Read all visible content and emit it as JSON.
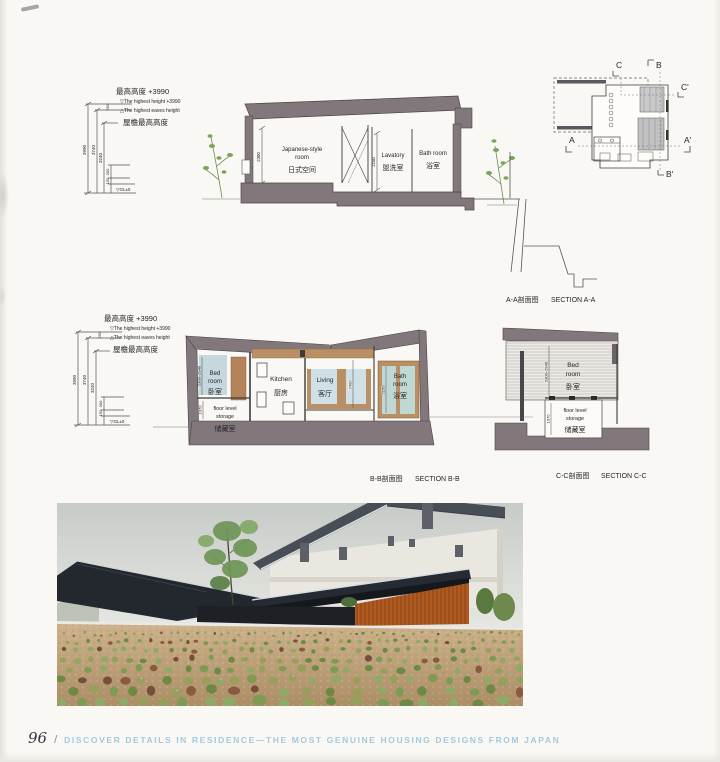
{
  "page": {
    "number": "96",
    "separator": "/",
    "footer_title": "DISCOVER DETAILS IN RESIDENCE—THE MOST GENUINE HOUSING DESIGNS FROM JAPAN"
  },
  "colors": {
    "roof_gray": "#82787c",
    "dark_line": "#4a4347",
    "wood_tan": "#b98f63",
    "wood_panel": "#b5835a",
    "glass_blue": "#cfe0e6",
    "bed_blue": "#c6d7dd",
    "photo_roof": "#23272e",
    "photo_wood": "#b05a22",
    "gravel": "#c6ab85",
    "plant_greens": [
      "#7d9c52",
      "#8fa967",
      "#6c8a43",
      "#96a05a",
      "#74503a",
      "#8a5a3f"
    ],
    "flower_pink": "#d9a0bd",
    "footer_blue": "#a3c9de"
  },
  "annotation_top": {
    "line1": "最高高度 +3990",
    "line2": "▽The highest height +3990",
    "line3": "△The highest eaves height",
    "line4": "屋檐最高高度",
    "dim_total": "3990",
    "dim_mid": "3740",
    "dim_inner": "3240",
    "dim_s_top": "250",
    "dim_s1": "300",
    "dim_s2": "150",
    "gl": "▽GL±0"
  },
  "annotation_mid": {
    "line1": "最高高度 +3990",
    "line2": "▽The highest height +3990",
    "line3": "△The highest eaves height",
    "line4": "屋檐最高高度",
    "dim_total": "3990",
    "dim_mid": "3740",
    "dim_inner": "3240",
    "dim_s_top": "250",
    "dim_s1": "300",
    "dim_s2": "150",
    "gl": "▽GL±0"
  },
  "section_a": {
    "caption_cn": "A-A剖面图",
    "caption_en": "SECTION A-A",
    "room1_en1": "Japanese-style",
    "room1_en2": "room",
    "room1_cn": "日式空间",
    "room1_dim": "2300",
    "room2_en": "Lavatory",
    "room2_cn": "盥洗室",
    "room2_dim": "2150",
    "room3_en": "Bath room",
    "room3_cn": "浴室"
  },
  "section_b": {
    "caption_cn": "B-B剖面图",
    "caption_en": "SECTION B-B",
    "bed_en1": "Bed",
    "bed_en2": "room",
    "bed_cn": "卧室",
    "bed_dim": "2300~2940",
    "storage_en1": "floor level",
    "storage_en2": "storage",
    "storage_cn": "储藏室",
    "storage_dim": "1070",
    "kitchen_en": "Kitchen",
    "kitchen_cn": "厨房",
    "living_en": "Living",
    "living_cn": "客厅",
    "living_dim": "2400",
    "bath_en1": "Bath",
    "bath_en2": "room",
    "bath_cn": "浴室",
    "bath_dim": "2150"
  },
  "section_c": {
    "caption_cn": "C-C剖面图",
    "caption_en": "SECTION C-C",
    "bed_en1": "Bed",
    "bed_en2": "room",
    "bed_cn": "卧室",
    "bed_dim": "2300~2940",
    "storage_en1": "floor level",
    "storage_en2": "storage",
    "storage_cn": "储藏室",
    "storage_dim": "1070"
  },
  "plan": {
    "a": "A",
    "a2": "A'",
    "b": "B",
    "b2": "B'",
    "c": "C",
    "c2": "C'"
  }
}
